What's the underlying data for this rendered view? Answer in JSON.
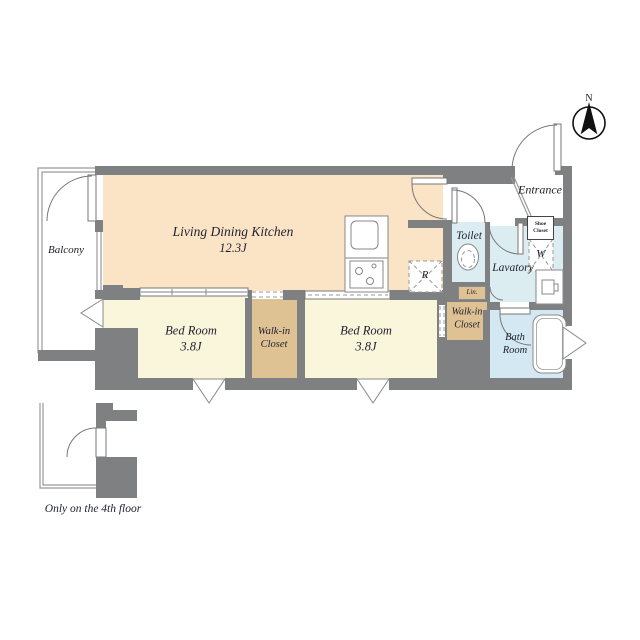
{
  "plan": {
    "compass": {
      "label": "N"
    },
    "note": "Only on the 4th floor",
    "rooms": {
      "ldk": {
        "name": "Living Dining Kitchen",
        "size": "12.3J"
      },
      "bedroom1": {
        "name": "Bed Room",
        "size": "3.8J"
      },
      "bedroom2": {
        "name": "Bed Room",
        "size": "3.8J"
      },
      "wic1": {
        "line1": "Walk-in",
        "line2": "Closet"
      },
      "wic2": {
        "line1": "Walk-in",
        "line2": "Closet"
      },
      "toilet": {
        "name": "Toilet"
      },
      "lavatory": {
        "name": "Lavatory"
      },
      "bath": {
        "line1": "Bath",
        "line2": "Room"
      },
      "entrance": {
        "name": "Entrance"
      },
      "balcony": {
        "name": "Balcony"
      }
    },
    "fixtures": {
      "shoe_closet": {
        "line1": "Shoe",
        "line2": "Closet"
      },
      "linen": "Lin.",
      "refrigerator": "R",
      "washer": "W"
    },
    "colors": {
      "wall": "#7e8082",
      "ldk": "#fae4c5",
      "bedroom": "#faf6dc",
      "closet": "#dfc294",
      "wet": "#dcedf2",
      "bath": "#d3e8f2",
      "text": "#1f1f2e"
    }
  }
}
